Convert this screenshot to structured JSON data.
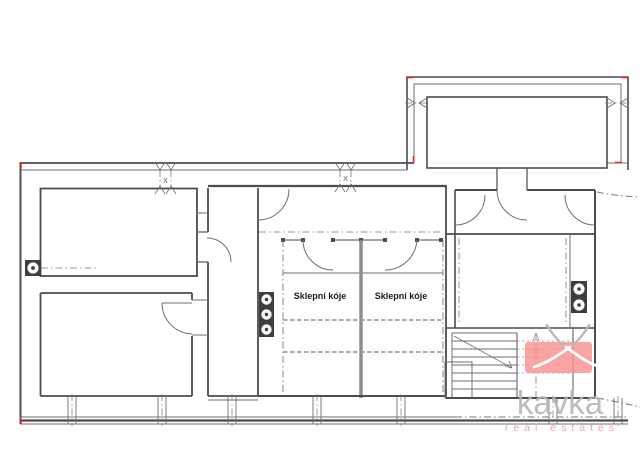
{
  "floor_plan": {
    "type": "basement-floor-plan",
    "storage_labels": {
      "left": "Sklepní kóje",
      "right": "Sklepní kóje"
    },
    "window_marks": {
      "left": "X",
      "right": "X"
    }
  },
  "watermark": {
    "brand": "kavka",
    "tagline": "real estates"
  },
  "colors": {
    "wall": "#4c4c4c",
    "thin_line": "#6f6f6f",
    "accent_red": "#ff2619",
    "storage_divider_gray": "#8d8d8d",
    "logo_pink": "#f8918f",
    "logo_text_gray": "#b4b4b4",
    "logo_tagline_pink": "#f2a3a1",
    "background": "#ffffff"
  }
}
